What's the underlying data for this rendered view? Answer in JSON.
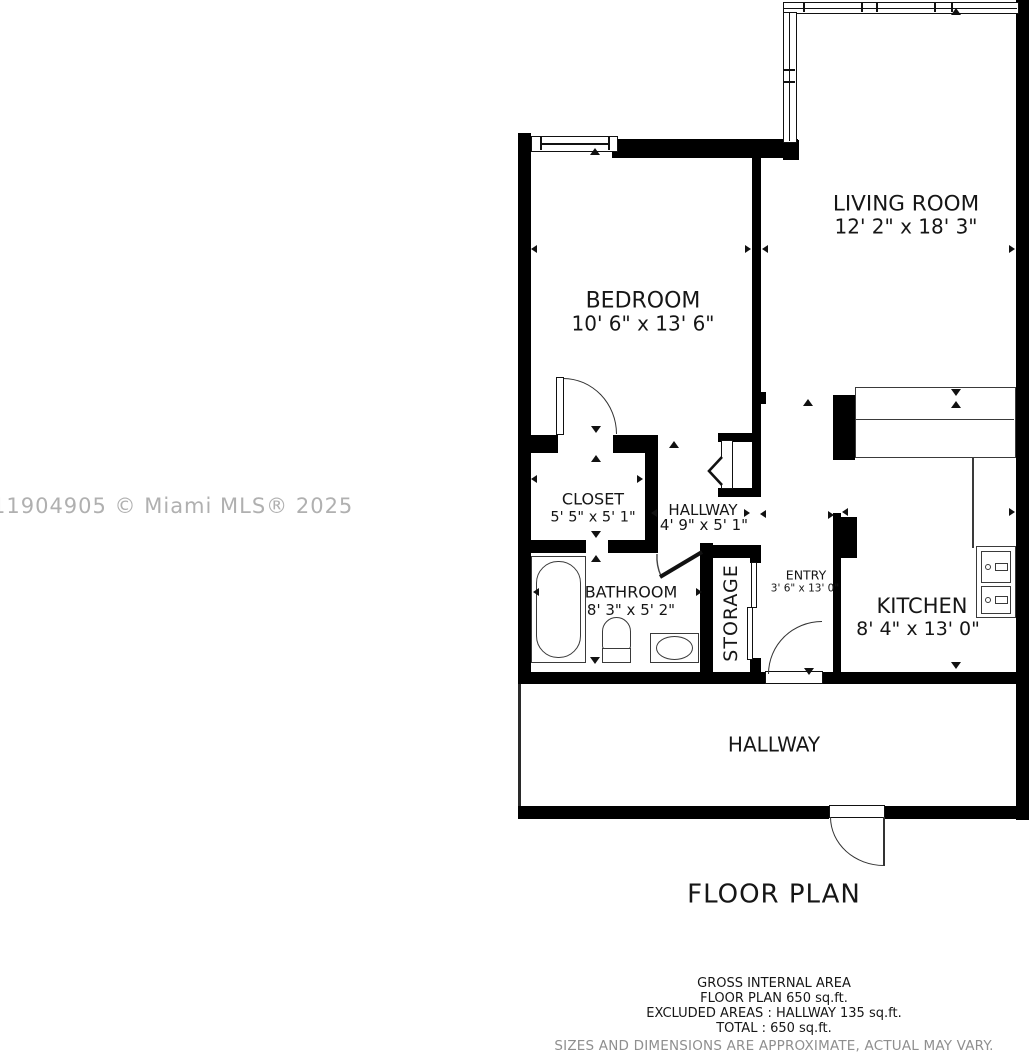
{
  "watermark": {
    "text": "11904905 © Miami MLS® 2025",
    "color": "#b0b0b0"
  },
  "plan": {
    "title": "FLOOR PLAN",
    "rooms": {
      "living_room": {
        "name": "LIVING ROOM",
        "dims": "12' 2\" x 18' 3\""
      },
      "bedroom": {
        "name": "BEDROOM",
        "dims": "10' 6\" x 13' 6\""
      },
      "closet": {
        "name": "CLOSET",
        "dims": "5' 5\" x 5' 1\""
      },
      "hallway": {
        "name": "HALLWAY",
        "dims": "4' 9\" x 5' 1\""
      },
      "bathroom": {
        "name": "BATHROOM",
        "dims": "8' 3\" x 5' 2\""
      },
      "storage": {
        "name": "STORAGE"
      },
      "entry": {
        "name": "ENTRY",
        "dims": "3' 6\" x 13' 0\""
      },
      "kitchen": {
        "name": "KITCHEN",
        "dims": "8' 4\" x 13' 0\""
      },
      "exterior_hallway": {
        "name": "HALLWAY"
      }
    }
  },
  "summary": {
    "gross_internal_area": "GROSS INTERNAL AREA",
    "floor_plan_area": "FLOOR PLAN 650 sq.ft.",
    "excluded_areas": "EXCLUDED AREAS :  HALLWAY 135 sq.ft.",
    "total": "TOTAL :  650 sq.ft.",
    "disclaimer": "SIZES AND DIMENSIONS ARE APPROXIMATE, ACTUAL MAY VARY."
  },
  "colors": {
    "wall": "#000000",
    "text": "#161616",
    "fixture": "#3a3a3a",
    "disclaimer": "#8f8f8f"
  }
}
